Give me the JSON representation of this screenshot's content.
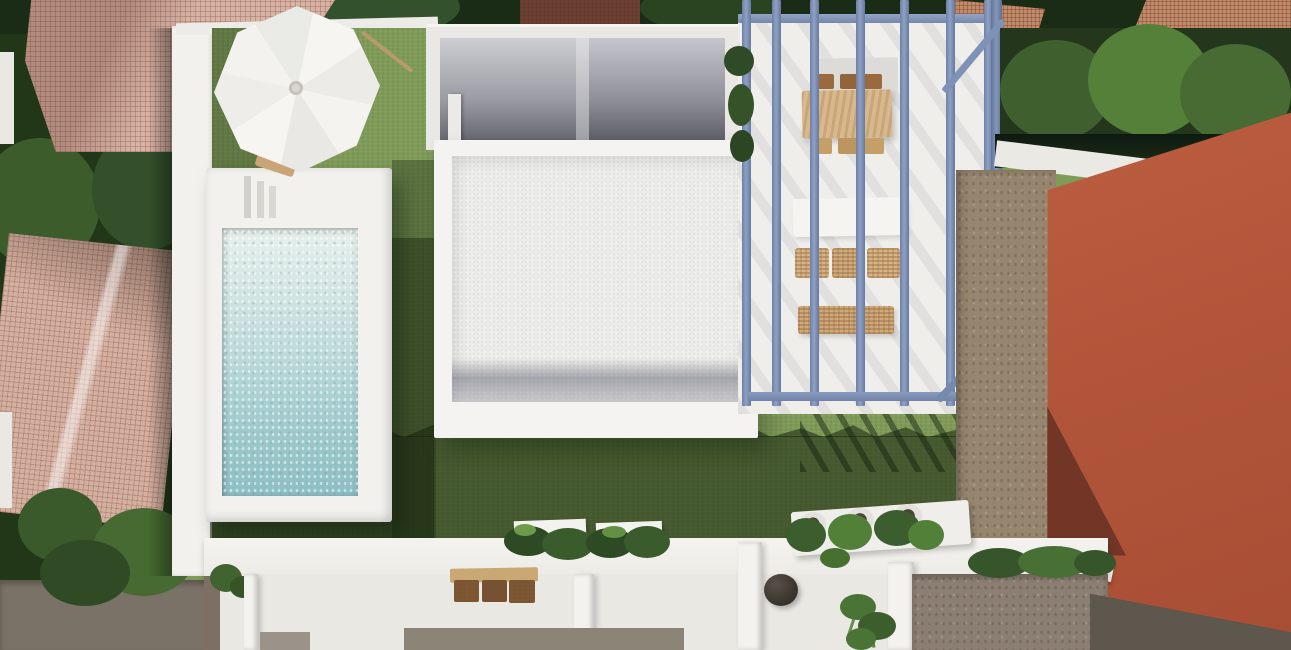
{
  "scene": {
    "description": "Top-down 3D architectural render of a modern villa plot: white-walled garden with lawn, rectangular pool with white deck, white parasol, flat-roofed house with cutaway interior rooms, blue-grey pergola over a dining terrace, gravel side yard, large terracotta neighbouring roof, lower terrace with planters, bench and fire bowl, surrounded by trees and tiled roofs",
    "view": "top-down",
    "objects": [
      "neighbour-roof-top-left",
      "neighbour-roof-left",
      "street-trees",
      "access-road",
      "boundary-wall",
      "garden-lawn",
      "lawn-shadow",
      "swimming-pool",
      "pool-deck",
      "pool-steps",
      "white-parasol",
      "sun-lounger",
      "garden-rake",
      "main-house-cutaway-rooms",
      "main-house-flat-roof",
      "roof-gutter-band",
      "interior-door",
      "pergola-blue-frame",
      "pergola-terrace",
      "outdoor-dining-table",
      "dining-chairs",
      "white-sofa",
      "rattan-cushions",
      "side-hedge",
      "white-curb",
      "gravel-strip",
      "terracotta-roof",
      "roof-shadow-wedge",
      "street-pavement",
      "tiled-patio-floor",
      "lower-terrace",
      "terrace-planters",
      "planter-shrubs",
      "potted-plants",
      "wooden-bench",
      "bench-cushions",
      "fire-bowl",
      "corner-plant",
      "interior-partition-walls"
    ],
    "palette": {
      "lawn": "#7F9B58",
      "lawn_shadow": "#3E5531",
      "pool_water": "#A9D0D3",
      "deck_white": "#F1F0EC",
      "pergola_blue": "#8195BA",
      "wood_tan": "#D2AE7C",
      "cushion_brown": "#7C5836",
      "terracotta_roof": "#B2573A",
      "pink_tile_roof": "#D8B2A4",
      "gravel": "#97866F",
      "tree_dark": "#2C431F",
      "tree_light": "#54803A",
      "interior_grey": "#8A8A93",
      "pavement": "#5D574D"
    }
  }
}
